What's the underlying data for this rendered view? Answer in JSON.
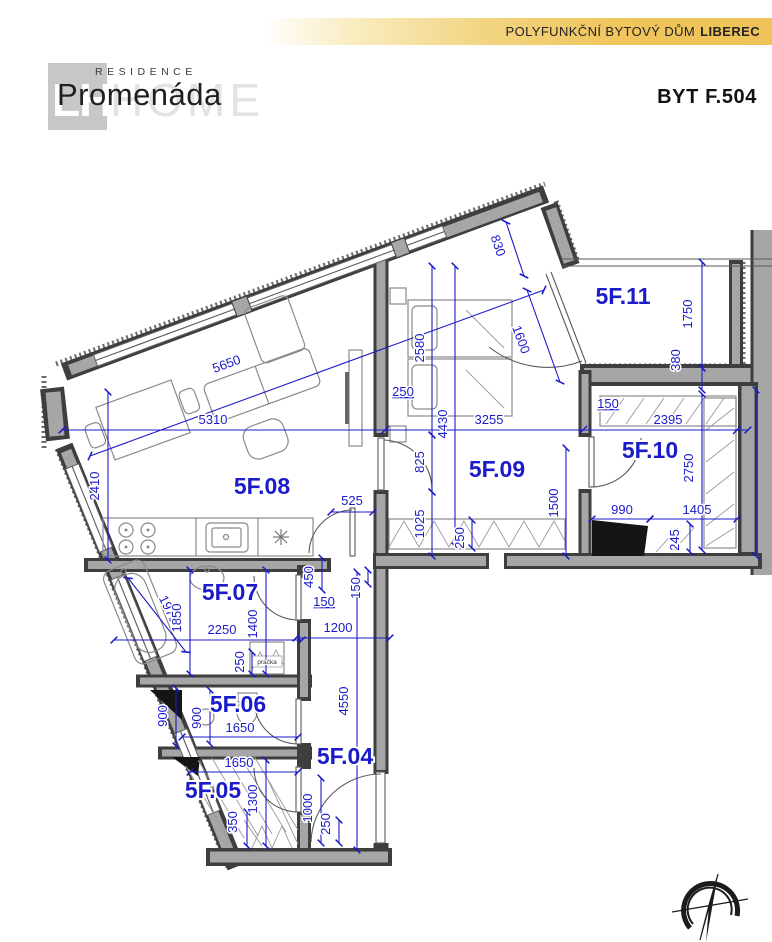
{
  "header": {
    "banner_text": "POLYFUNKČNÍ BYTOVÝ DŮM",
    "banner_city": "LIBEREC",
    "unit_title": "BYT F.504"
  },
  "logo": {
    "tagline": "RESIDENCE",
    "name": "Promenáda",
    "watermark_left": "LH",
    "watermark_right": "HOME"
  },
  "colors": {
    "dimension_blue": "#1b1bc9",
    "wall_dark": "#3e3e3e",
    "wall_gray": "#a6a6a6",
    "banner_gold": "#eec258"
  },
  "plan": {
    "rooms": [
      "5F.04",
      "5F.05",
      "5F.06",
      "5F.07",
      "5F.08",
      "5F.09",
      "5F.10",
      "5F.11"
    ],
    "appliance_label": "pračka",
    "dims": [
      "5650",
      "5310",
      "2410",
      "525",
      "250",
      "830",
      "1600",
      "2580",
      "4430",
      "3255",
      "825",
      "1025",
      "250",
      "1500",
      "1750",
      "380",
      "150",
      "2395",
      "2750",
      "990",
      "1405",
      "245",
      "1970",
      "1850",
      "2250",
      "1400",
      "250",
      "450",
      "150",
      "150",
      "1200",
      "4550",
      "1000",
      "250",
      "900",
      "900",
      "1650",
      "1650",
      "1300",
      "350"
    ]
  }
}
